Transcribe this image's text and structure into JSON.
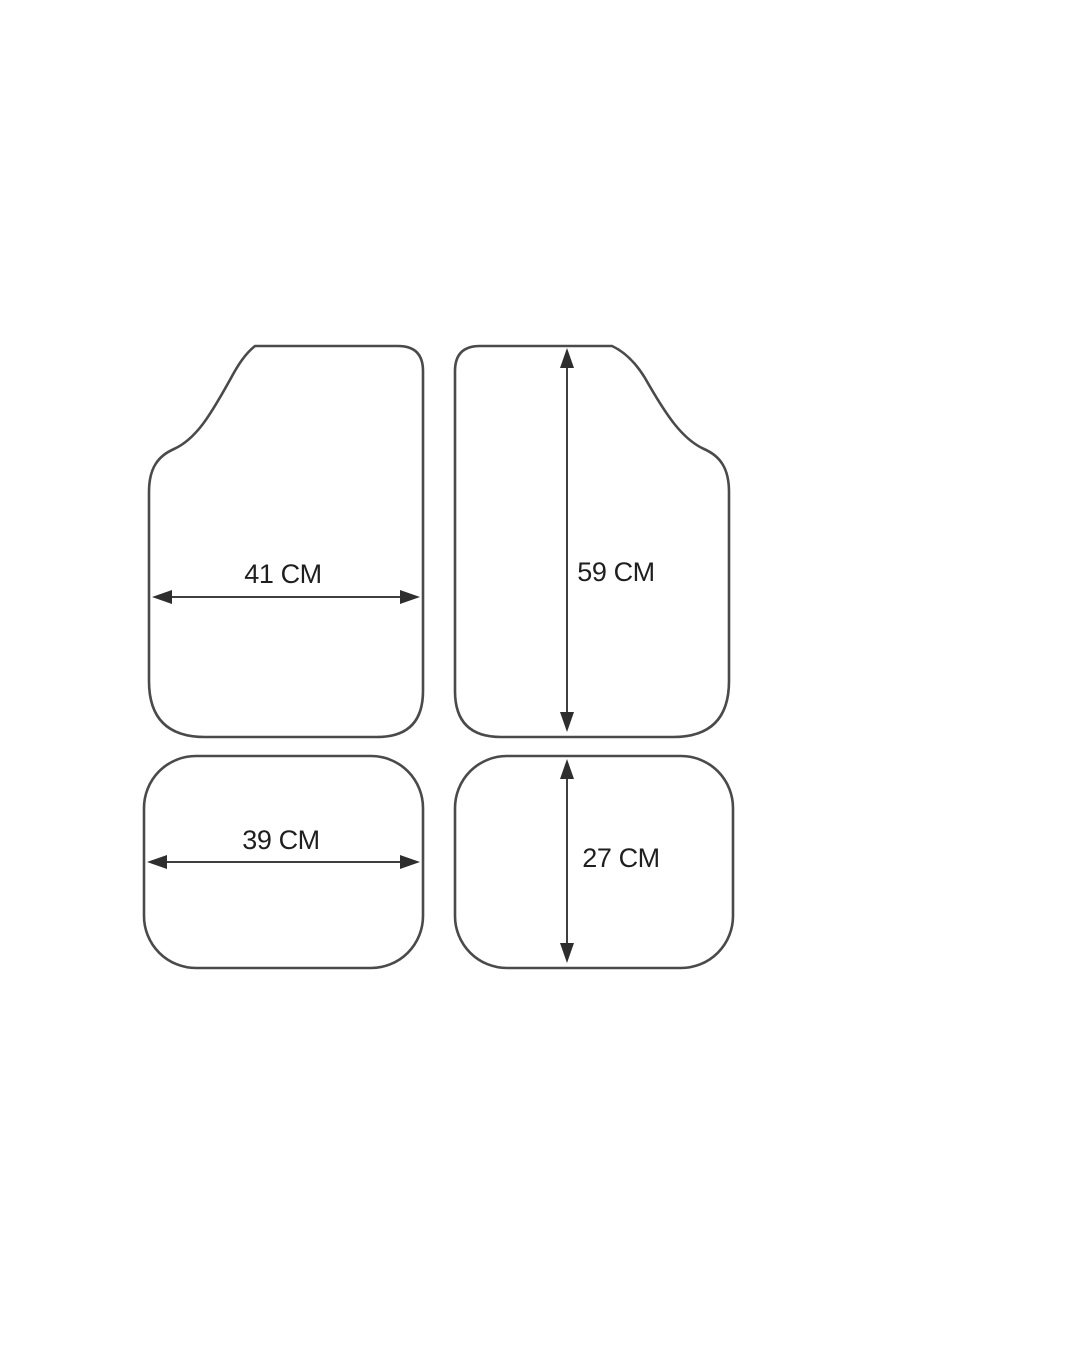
{
  "diagram": {
    "type": "product-dimensions",
    "unit": "CM",
    "mats": [
      {
        "name": "front-left-mat",
        "dimension": "width",
        "value": 41,
        "label": "41 CM"
      },
      {
        "name": "front-right-mat",
        "dimension": "height",
        "value": 59,
        "label": "59 CM"
      },
      {
        "name": "rear-left-mat",
        "dimension": "width",
        "value": 39,
        "label": "39 CM"
      },
      {
        "name": "rear-right-mat",
        "dimension": "height",
        "value": 27,
        "label": "27 CM"
      }
    ]
  },
  "colors": {
    "background": "#ffffff",
    "outline-stroke": "#4a4a4a",
    "arrow-stroke": "#3f3f3f",
    "arrow-fill": "#2e2e2e",
    "text-color": "#1f1f1f"
  }
}
